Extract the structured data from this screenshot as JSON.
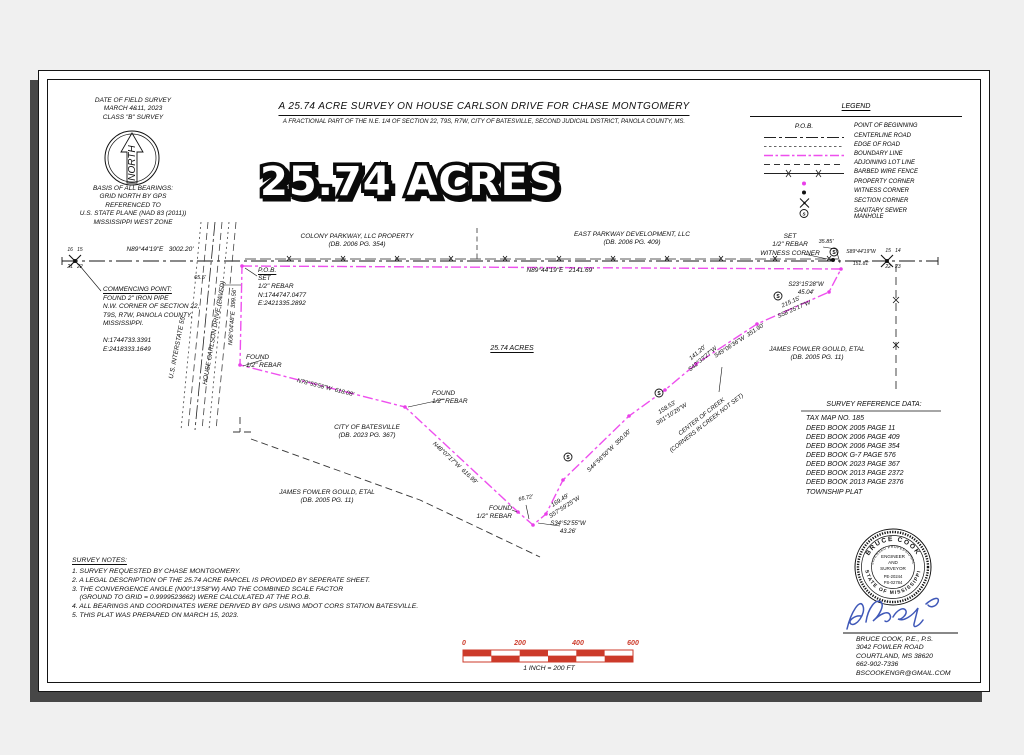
{
  "header": {
    "date_block": "DATE OF FIELD SURVEY\nMARCH 4&11, 2023\nCLASS \"B\" SURVEY",
    "north_label": "NORTH",
    "basis_block": "BASIS OF ALL BEARINGS:\nGRID NORTH BY GPS\nREFERENCED TO\nU.S. STATE PLANE (NAD 83 (2011))\nMISSISSIPPI WEST ZONE",
    "title": "A 25.74 ACRE SURVEY ON HOUSE CARLSON DRIVE FOR CHASE MONTGOMERY",
    "subtitle": "A FRACTIONAL PART OF THE N.E. 1/4 OF SECTION 22, T9S, R7W, CITY OF BATESVILLE, SECOND JUDICIAL DISTRICT, PANOLA COUNTY, MS.",
    "acres_big": "25.74 ACRES"
  },
  "legend": {
    "title": "LEGEND",
    "pob_symbol": "P.O.B.",
    "items": [
      {
        "label": "POINT OF BEGINNING"
      },
      {
        "label": "CENTERLINE ROAD"
      },
      {
        "label": "EDGE OF ROAD"
      },
      {
        "label": "BOUNDARY LINE"
      },
      {
        "label": "ADJOINING LOT LINE"
      },
      {
        "label": "BARBED WIRE FENCE"
      },
      {
        "label": "PROPERTY CORNER"
      },
      {
        "label": "WITNESS CORNER"
      },
      {
        "label": "SECTION CORNER"
      },
      {
        "label": "SANITARY SEWER\nMANHOLE"
      }
    ]
  },
  "icons": {
    "manhole_letter": "S"
  },
  "map": {
    "labels": {
      "b3002": "N89°44'19\"E   3002.20'",
      "secnw_top": "16   15",
      "secnw_bot": "21   22",
      "commencing_title": "COMMENCING POINT:",
      "commencing_body": "FOUND 2\" IRON PIPE\nN.W. CORNER OF SECTION 22,\nT9S, R7W, PANOLA COUNTY,\nMISSISSIPPI.\n\nN:1744733.3391\nE:2418333.1649",
      "i55": "U.S. INTERSTATE 55",
      "hcd": "HOUSE CARLSON DRIVE (PAVED)",
      "d655": "65.5'",
      "pob_title": "P.O.B.",
      "pob_body": "SET\n1/2\" REBAR\nN:1744747.0477\nE:2421335.2892",
      "colony": "COLONY PARKWAY, LLC PROPERTY\n(DB. 2006 PG. 354)",
      "east": "EAST PARKWAY DEVELOPMENT, LLC\n(DB. 2006 PG. 409)",
      "b2141": "N89°44'19\"E   2141.69'",
      "witness": "SET\n1/2\" REBAR\nWITNESS CORNER",
      "d3585": "35.85'",
      "s89": "S89°44'19\"W",
      "d15181": "151.81'",
      "secne_top": "15   14",
      "secne_bot": "22   23",
      "s2315": "S23°15'28\"W\n45.04'",
      "s5825": "215.15'\nS58°25'17\"W",
      "s4906": "S49°06'36\"W  351.90'",
      "s4233": "141.20'\nS42°33'27\"W",
      "s6110": "158.53'\nS61°10'26\"W",
      "creek": "CENTER OF CREEK\n(CORNERS IN CREEK NOT SET)",
      "s4456": "S44°56'50\"W  350.00'",
      "acres_mid": "25.74 ACRES",
      "city": "CITY OF BATESVILLE\n(DB. 2023 PG. 367)",
      "gould": "JAMES FOWLER GOULD, ETAL\n(DB. 2005 PG. 11)",
      "found_rebar": "FOUND\n1/2\" REBAR",
      "d6572": "65.72'",
      "s5759": "169.49'\nS57°59'25\"W",
      "s3452": "S34°52'55\"W\n43.26'",
      "n4807": "N48°07'17\"W  616.99'",
      "n7855": "N78°55'58\"W  618.08'",
      "n0604": "N06°04'48\"E  399.56'"
    }
  },
  "reference": {
    "title": "SURVEY REFERENCE DATA:",
    "tax": "TAX MAP NO. 185",
    "deeds": "DEED BOOK 2005 PAGE 11\nDEED BOOK 2006 PAGE 409\nDEED BOOK 2006 PAGE 354\nDEED BOOK G-7 PAGE 576\nDEED BOOK 2023 PAGE 367\nDEED BOOK 2013 PAGE 2372\nDEED BOOK 2013 PAGE 2376",
    "township": "TOWNSHIP PLAT"
  },
  "notes": {
    "title": "SURVEY NOTES:",
    "n1": "1. SURVEY REQUESTED BY CHASE MONTGOMERY.",
    "n2": "2. A LEGAL DESCRIPTION OF THE 25.74 ACRE PARCEL IS PROVIDED BY SEPERATE SHEET.",
    "n3": "3. THE CONVERGENCE ANGLE (N00°13'58\"W) AND THE COMBINED SCALE FACTOR\n    (GROUND TO GRID = 0.9999523662) WERE CALCULATED AT THE P.O.B.",
    "n4": "4. ALL BEARINGS AND COORDINATES WERE DERIVED BY GPS USING MDOT CORS STATION BATESVILLE.",
    "n5": "5. THIS PLAT WAS PREPARED ON MARCH 15, 2023."
  },
  "scalebar": {
    "t0": "0",
    "t200": "200",
    "t400": "400",
    "t600": "600",
    "caption": "1 INCH = 200 FT"
  },
  "seal": {
    "arc_top": "BRUCE COOK",
    "arc_mid": "LICENSED PROFESSIONAL",
    "arc_bottom": "STATE OF MISSISSIPPI",
    "c1": "ENGINEER",
    "c2": "AND",
    "c3": "SURVEYOR",
    "c4": "PE-20244",
    "c5": "PS-02784",
    "contact": "BRUCE COOK, P.E., P.S.\n3042 FOWLER ROAD\nCOURTLAND, MS 38620\n662-902-7336\nBSCOOKENGR@GMAIL.COM"
  },
  "colors": {
    "boundary": "#ee4fee",
    "corner": "#e93fe9",
    "scale_red": "#cc3a2a",
    "signature_blue": "#3f58b8"
  }
}
